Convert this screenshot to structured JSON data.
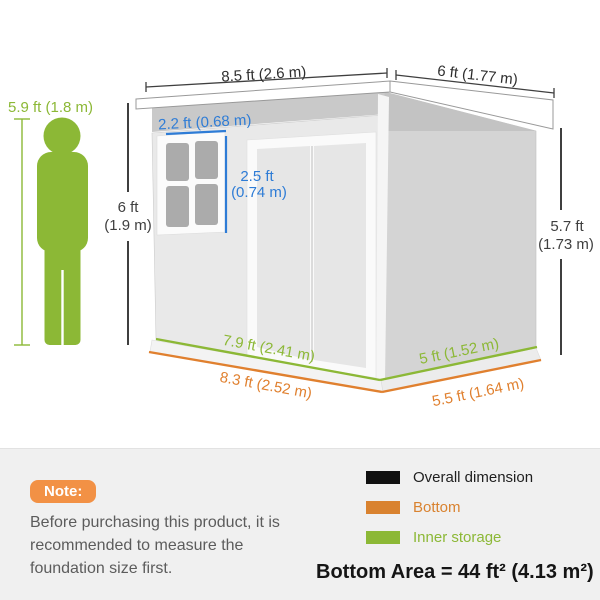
{
  "colors": {
    "green": "#8cb836",
    "orange_line": "#e0802f",
    "orange_badge": "#f29145",
    "orange_legend": "#d9822f",
    "blue": "#2e7cd6",
    "dark_dim": "#3f3f3f",
    "black_swatch": "#111111"
  },
  "diagram": {
    "person_height": "5.9 ft (1.8 m)",
    "roof_front_width": "8.5 ft (2.6 m)",
    "roof_side_width": "6 ft (1.77 m)",
    "window_width": "2.2 ft (0.68 m)",
    "window_height_line1": "2.5 ft",
    "window_height_line2": "(0.74 m)",
    "front_height_line1": "6 ft",
    "front_height_line2": "(1.9 m)",
    "side_height_line1": "5.7 ft",
    "side_height_line2": "(1.73 m)",
    "inner_front_width": "7.9 ft (2.41 m)",
    "bottom_front_width": "8.3 ft (2.52 m)",
    "inner_side_width": "5 ft (1.52 m)",
    "bottom_side_width": "5.5 ft (1.64 m)"
  },
  "note": {
    "badge": "Note:",
    "text": "Before purchasing this product, it is recommended to measure the foundation size first."
  },
  "legend": {
    "items": [
      {
        "label": "Overall dimension",
        "color": "#111111"
      },
      {
        "label": "Bottom",
        "color": "#d9822f"
      },
      {
        "label": "Inner storage",
        "color": "#8cb836"
      }
    ]
  },
  "bottom_area": "Bottom Area = 44 ft² (4.13 m²)"
}
